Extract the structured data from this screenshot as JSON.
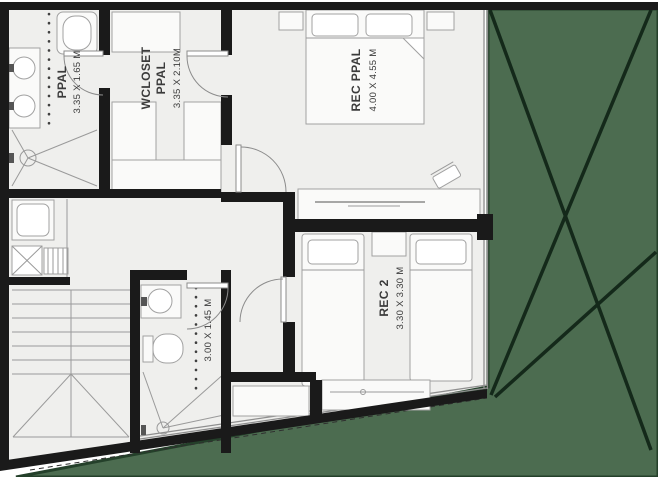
{
  "rooms": {
    "bath_ppal": {
      "name": "PPAL",
      "dims": "3.35 X 1.65 M"
    },
    "wcloset_ppal": {
      "name_line1": "WCLOSET",
      "name_line2": "PPAL",
      "dims": "3.35 X 2.10M"
    },
    "rec_ppal": {
      "name": "REC PPAL",
      "dims": "4.00 X 4.55 M"
    },
    "rec_2": {
      "name": "REC 2",
      "dims": "3.30 X 3.30 M"
    },
    "bath_2": {
      "dims": "3.00 X 1.45 M"
    }
  },
  "colors": {
    "wall": "#1a1a1a",
    "floor": "#efefed",
    "outside": "#ffffff",
    "green": "#4c6c50",
    "green_edge": "#24402a",
    "green_line": "#14291a",
    "furniture_stroke": "#a1a1a1",
    "label": "#3b3b3b"
  },
  "fixtures": [
    "toilet-icon",
    "double-sink-vanity-icon",
    "shower-icon",
    "washer-icon",
    "water-heater-icon",
    "stairs-icon",
    "double-bed-icon",
    "single-bed-icon",
    "nightstand-icon",
    "dresser-icon",
    "chair-icon",
    "closet-shelves-icon",
    "door-swing-icon",
    "window-icon",
    "void-cross-icon"
  ]
}
